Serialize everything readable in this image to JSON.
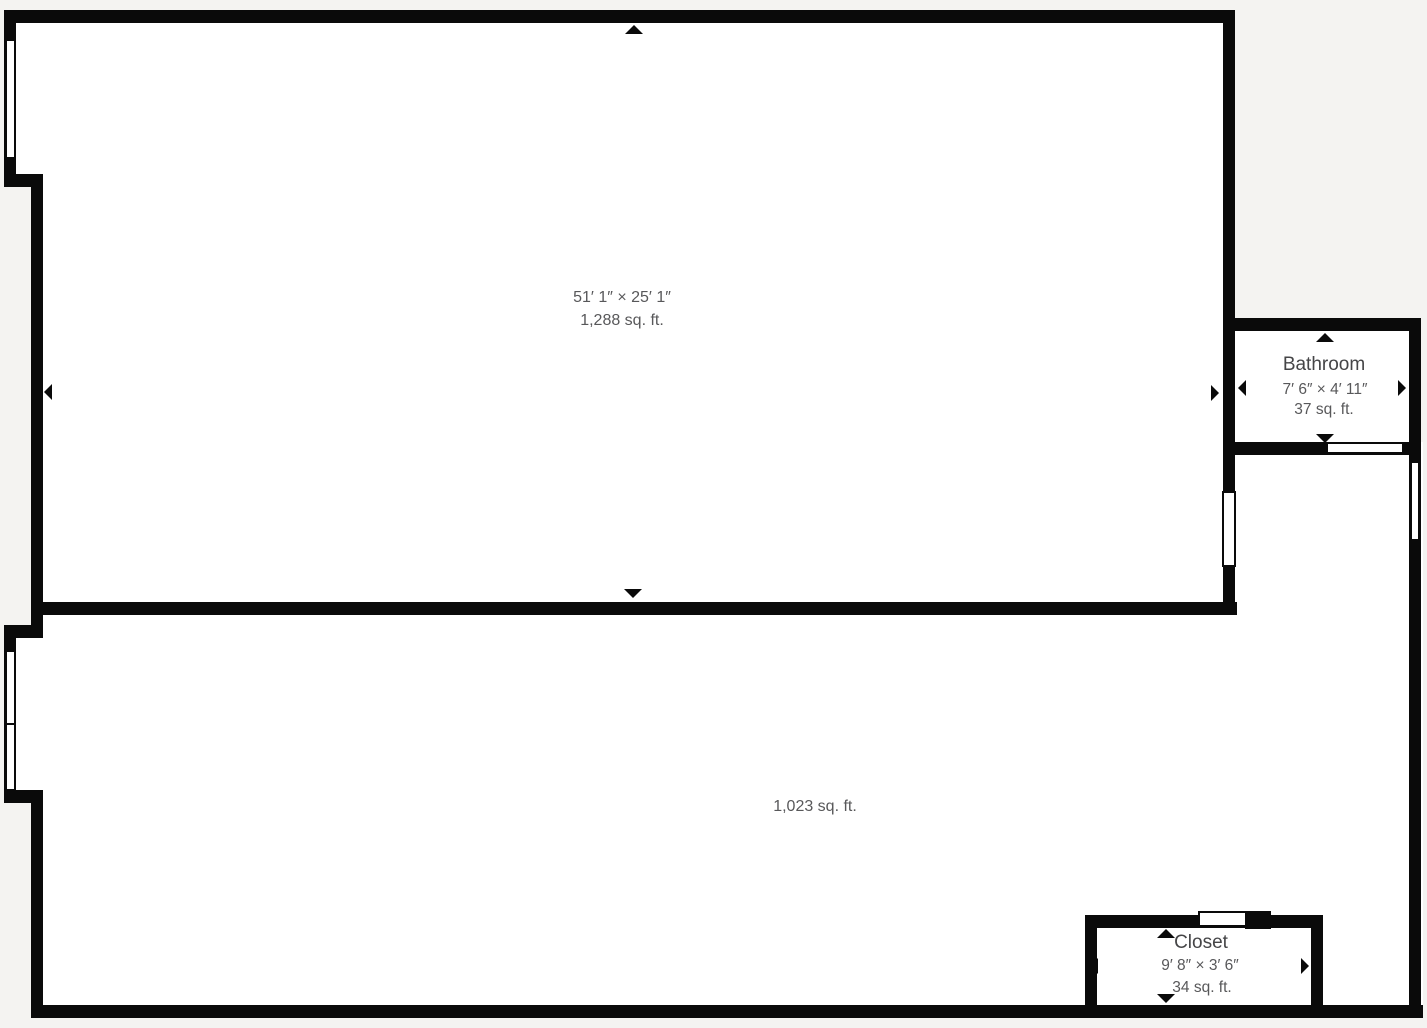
{
  "palette": {
    "background": "#f4f3f1",
    "wall": "#0a0a0a",
    "room_fill": "#ffffff",
    "label_text": "#454547",
    "dimension_text": "#58585a"
  },
  "icons": {
    "dimension_arrow": "black triangle marker (up/down/left/right)"
  },
  "rooms": {
    "main": {
      "dimensions": "51′ 1″ × 25′ 1″",
      "area": "1,288 sq. ft."
    },
    "lower": {
      "area": "1,023 sq. ft."
    },
    "bathroom": {
      "label": "Bathroom",
      "dimensions": "7′ 6″ × 4′ 11″",
      "area": "37 sq. ft."
    },
    "closet": {
      "label": "Closet",
      "dimensions": "9′ 8″ × 3′ 6″",
      "area": "34 sq. ft."
    }
  }
}
